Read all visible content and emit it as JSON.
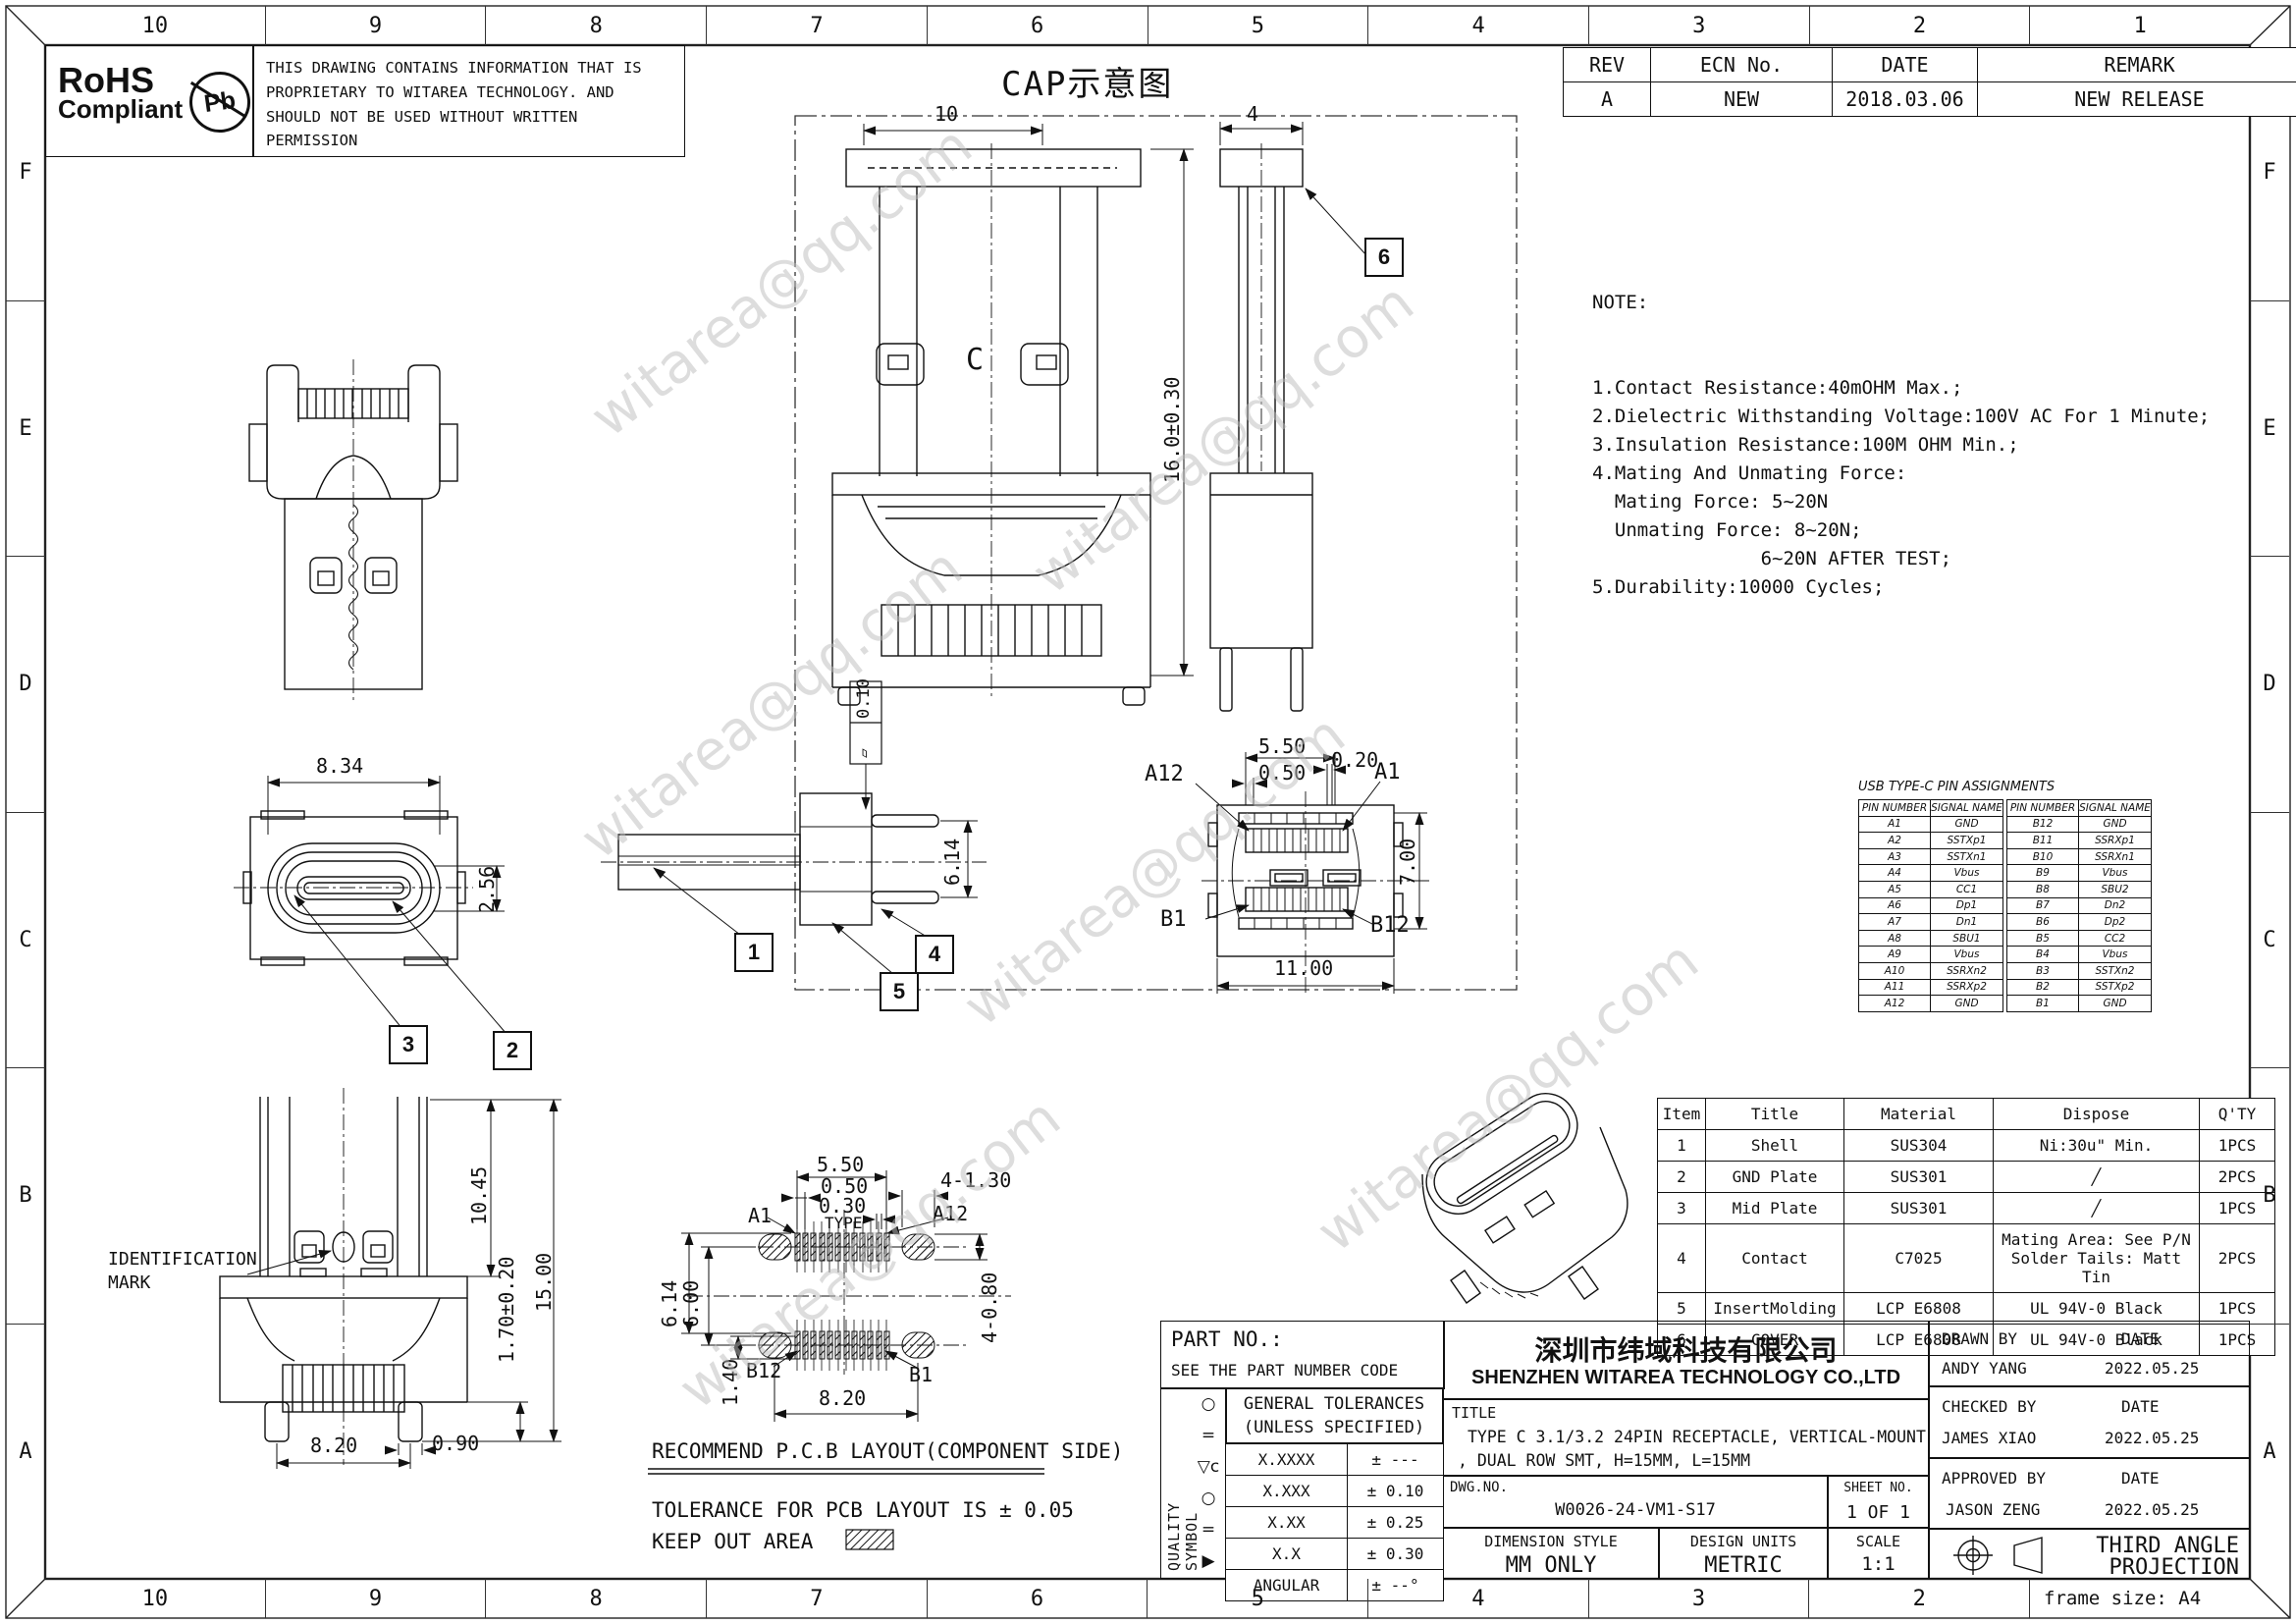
{
  "border": {
    "top_cols": [
      "10",
      "9",
      "8",
      "7",
      "6",
      "5",
      "4",
      "3",
      "2",
      "1"
    ],
    "bottom_cols": [
      "10",
      "9",
      "8",
      "7",
      "6",
      "5",
      "4",
      "3",
      "2"
    ],
    "rows": [
      "F",
      "E",
      "D",
      "C",
      "B",
      "A"
    ],
    "frame_size": "frame size: A4"
  },
  "header": {
    "rohs_line1": "RoHS",
    "rohs_line2": "Compliant",
    "pb": "Pb",
    "proprietary": "THIS DRAWING CONTAINS INFORMATION THAT IS PROPRIETARY TO WITAREA TECHNOLOGY. AND SHOULD NOT BE USED WITHOUT WRITTEN PERMISSION"
  },
  "rev_table": {
    "headers": [
      "REV",
      "ECN No.",
      "DATE",
      "REMARK"
    ],
    "rows": [
      [
        "A",
        "NEW",
        "2018.03.06",
        "NEW RELEASE"
      ]
    ]
  },
  "cap": {
    "title": "CAP示意图"
  },
  "notes": {
    "title": "NOTE:",
    "lines": [
      "1.Contact Resistance:40mOHM Max.;",
      "2.Dielectric Withstanding Voltage:100V AC For 1 Minute;",
      "3.Insulation Resistance:100M OHM Min.;",
      "4.Mating And Unmating Force:",
      "  Mating Force: 5~20N",
      "  Unmating Force: 8~20N;",
      "               6~20N AFTER TEST;",
      "5.Durability:10000 Cycles;"
    ]
  },
  "dims": {
    "cap_w": "10",
    "cap_side_w": "4",
    "cap_h": "16.0±0.30",
    "cap_c": "C",
    "tv_w": "8.34",
    "tv_h": "2.56",
    "sv_h": "6.14",
    "flatness": "0.10",
    "flat_glyph": "▱",
    "pf_550": "5.50",
    "pf_020": "0.20",
    "pf_050": "0.50",
    "pf_700": "7.00",
    "pf_1100": "11.00",
    "pf_a12": "A12",
    "pf_a1": "A1",
    "pf_b1": "B1",
    "pf_b12": "B12",
    "mv_1045": "10.45",
    "mv_1500": "15.00",
    "mv_170": "1.70±0.20",
    "mv_090": "0.90",
    "mv_820": "8.20",
    "pcb_550": "5.50",
    "pcb_050": "0.50",
    "pcb_030": "0.30",
    "pcb_type": "TYPE",
    "pcb_4130": "4-1.30",
    "pcb_a1": "A1",
    "pcb_a12": "A12",
    "pcb_614": "6.14",
    "pcb_600": "6.00",
    "pcb_4080": "4-0.80",
    "pcb_140": "1.40",
    "pcb_b12": "B12",
    "pcb_b1": "B1",
    "pcb_820": "8.20"
  },
  "balloons": {
    "b1": "1",
    "b2": "2",
    "b3": "3",
    "b4": "4",
    "b5": "5",
    "b6": "6"
  },
  "labels": {
    "id_line1": "IDENTIFICATION",
    "id_line2": "MARK",
    "pcb_recommend": "RECOMMEND P.C.B LAYOUT(COMPONENT SIDE)",
    "pcb_tolerance": "TOLERANCE FOR PCB LAYOUT IS ± 0.05",
    "pcb_keepout": "KEEP OUT AREA"
  },
  "pin_table": {
    "title": "USB TYPE-C PIN ASSIGNMENTS",
    "headers": [
      "PIN NUMBER",
      "SIGNAL NAME"
    ],
    "left_rows": [
      [
        "A1",
        "GND"
      ],
      [
        "A2",
        "SSTXp1"
      ],
      [
        "A3",
        "SSTXn1"
      ],
      [
        "A4",
        "Vbus"
      ],
      [
        "A5",
        "CC1"
      ],
      [
        "A6",
        "Dp1"
      ],
      [
        "A7",
        "Dn1"
      ],
      [
        "A8",
        "SBU1"
      ],
      [
        "A9",
        "Vbus"
      ],
      [
        "A10",
        "SSRXn2"
      ],
      [
        "A11",
        "SSRXp2"
      ],
      [
        "A12",
        "GND"
      ]
    ],
    "right_rows": [
      [
        "B12",
        "GND"
      ],
      [
        "B11",
        "SSRXp1"
      ],
      [
        "B10",
        "SSRXn1"
      ],
      [
        "B9",
        "Vbus"
      ],
      [
        "B8",
        "SBU2"
      ],
      [
        "B7",
        "Dn2"
      ],
      [
        "B6",
        "Dp2"
      ],
      [
        "B5",
        "CC2"
      ],
      [
        "B4",
        "Vbus"
      ],
      [
        "B3",
        "SSTXn2"
      ],
      [
        "B2",
        "SSTXp2"
      ],
      [
        "B1",
        "GND"
      ]
    ]
  },
  "bom": {
    "headers": [
      "Item",
      "Title",
      "Material",
      "Dispose",
      "Q'TY"
    ],
    "rows": [
      [
        "1",
        "Shell",
        "SUS304",
        "Ni:30u\" Min.",
        "1PCS"
      ],
      [
        "2",
        "GND Plate",
        "SUS301",
        "╱",
        "2PCS"
      ],
      [
        "3",
        "Mid Plate",
        "SUS301",
        "╱",
        "1PCS"
      ],
      [
        "4",
        "Contact",
        "C7025",
        "Mating Area: See P/N\nSolder Tails: Matt Tin",
        "2PCS"
      ],
      [
        "5",
        "InsertMolding",
        "LCP E6808",
        "UL 94V-0 Black",
        "1PCS"
      ],
      [
        "6",
        "COVER",
        "LCP E6808",
        "UL 94V-0 Black",
        "1PCS"
      ]
    ]
  },
  "title_block": {
    "part_no_label": "PART NO.:",
    "part_no_value": "SEE THE PART NUMBER CODE",
    "company_cn": "深圳市纬域科技有限公司",
    "company_en": "SHENZHEN WITAREA TECHNOLOGY CO.,LTD",
    "title_label": "TITLE",
    "title_line1": "TYPE C 3.1/3.2 24PIN RECEPTACLE, VERTICAL-MOUNT",
    "title_line2": ", DUAL ROW SMT, H=15MM, L=15MM",
    "general_tol_line1": "GENERAL TOLERANCES",
    "general_tol_line2": "(UNLESS SPECIFIED)",
    "tol_rows": [
      [
        "X.XXXX",
        "± ---"
      ],
      [
        "X.XXX",
        "± 0.10"
      ],
      [
        "X.XX",
        "± 0.25"
      ],
      [
        "X.X",
        "± 0.30"
      ],
      [
        "ANGULAR",
        "± --°"
      ]
    ],
    "quality_symbol_label": "QUALITY SYMBOL",
    "quality_symbols": [
      "○",
      "=",
      "▽c",
      "○",
      "=",
      "▶"
    ],
    "dwg_label": "DWG.NO.",
    "dwg_no": "W0026-24-VM1-S17",
    "sheet_label": "SHEET NO.",
    "sheet_value": "1 OF 1",
    "dim_style_label": "DIMENSION STYLE",
    "dim_style_value": "MM ONLY",
    "units_label": "DESIGN UNITS",
    "units_value": "METRIC",
    "scale_label": "SCALE",
    "scale_value": "1:1",
    "drawn_label": "DRAWN BY",
    "drawn_name": "ANDY YANG",
    "checked_label": "CHECKED BY",
    "checked_name": "JAMES XIAO",
    "approved_label": "APPROVED BY",
    "approved_name": "JASON ZENG",
    "date_label": "DATE",
    "drawn_date": "2022.05.25",
    "checked_date": "2022.05.25",
    "approved_date": "2022.05.25",
    "projection_line1": "THIRD ANGLE",
    "projection_line2": "PROJECTION"
  },
  "watermark": {
    "text": "witarea@qq.com"
  }
}
